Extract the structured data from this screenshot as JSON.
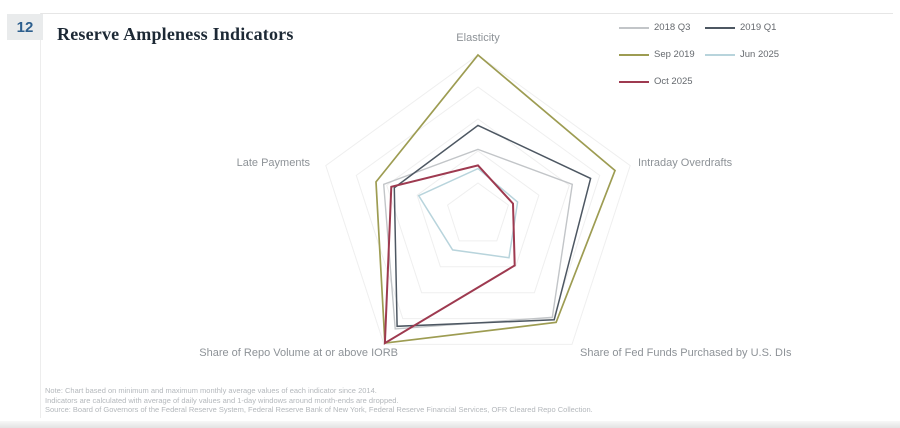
{
  "page": {
    "number_badge": "12"
  },
  "header": {
    "title": "Reserve Ampleness Indicators"
  },
  "chart_data": {
    "type": "radar",
    "title": "Reserve Ampleness Indicators",
    "axes": [
      "Elasticity",
      "Intraday Overdrafts",
      "Share of Fed Funds Purchased by U.S. DIs",
      "Share of Repo Volume at or above IORB",
      "Late Payments"
    ],
    "range": [
      0,
      1
    ],
    "rings": [
      0.2,
      0.4,
      0.6,
      0.8,
      1.0
    ],
    "grid_color": "#efefef",
    "legend_position": "top-right",
    "series": [
      {
        "name": "2018 Q3",
        "color": "#c2c5c8",
        "width": 1.4,
        "values": [
          0.41,
          0.62,
          0.79,
          0.88,
          0.62
        ]
      },
      {
        "name": "2019 Q1",
        "color": "#4d5762",
        "width": 1.5,
        "values": [
          0.56,
          0.74,
          0.81,
          0.86,
          0.55
        ]
      },
      {
        "name": "Sep 2019",
        "color": "#9d9c52",
        "width": 1.7,
        "values": [
          1.0,
          0.9,
          0.83,
          0.99,
          0.67
        ]
      },
      {
        "name": "Jun 2025",
        "color": "#b8d4dc",
        "width": 1.5,
        "values": [
          0.29,
          0.26,
          0.33,
          0.27,
          0.39
        ]
      },
      {
        "name": "Oct 2025",
        "color": "#9e3a50",
        "width": 2.0,
        "values": [
          0.31,
          0.23,
          0.39,
          0.99,
          0.57
        ]
      }
    ]
  },
  "footnotes": {
    "line1": "Note: Chart based on minimum and maximum monthly average values of each indicator since 2014.",
    "line2": "Indicators are calculated with average of daily values and 1-day windows around month-ends are dropped.",
    "line3": "Source: Board of Governors of the Federal Reserve System, Federal Reserve Bank of New York, Federal Reserve Financial Services, OFR Cleared Repo Collection."
  }
}
